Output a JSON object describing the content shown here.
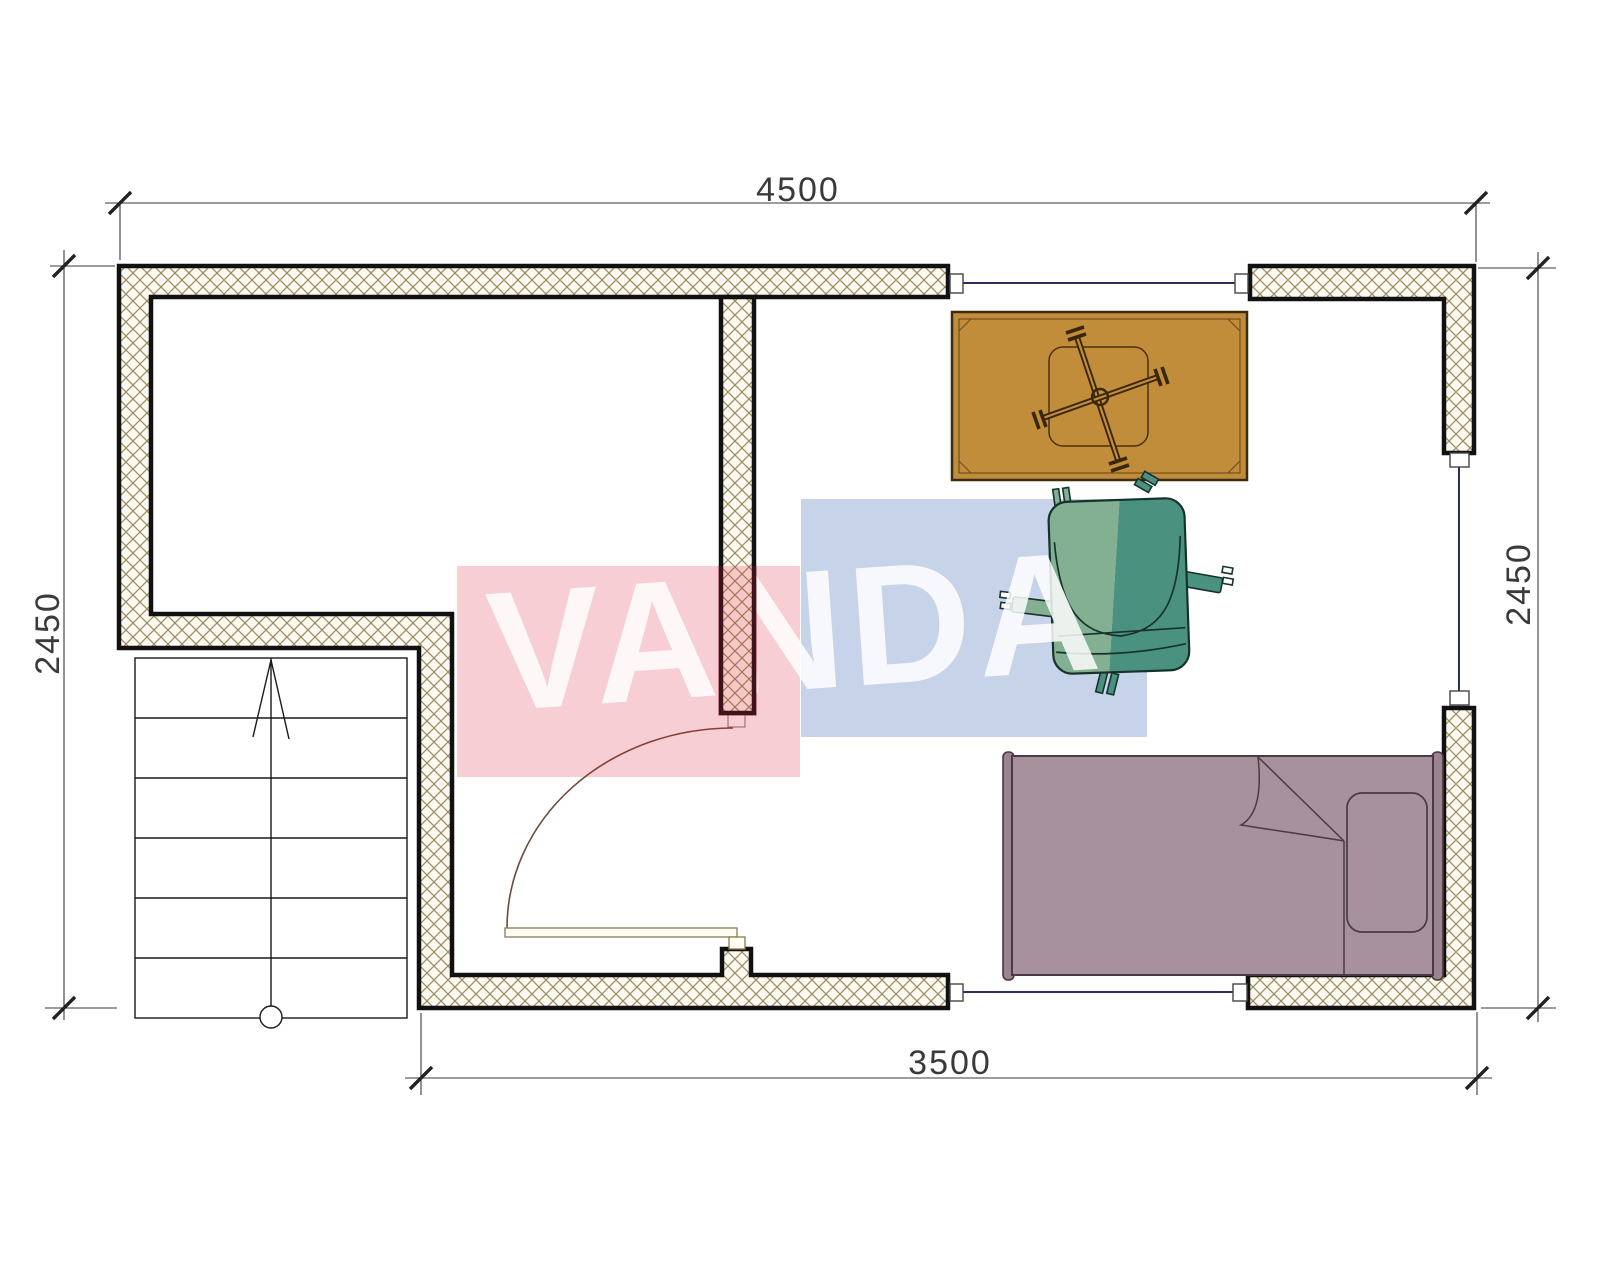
{
  "watermark": {
    "text": "VANDA",
    "text_style": "color: rgba(255,255,255,0.84)",
    "red_overlay": "rgba(220,30,55,0.22)",
    "blue_overlay": "rgba(70,110,180,0.30)"
  },
  "dimensions": {
    "top_label": "4500",
    "left_label": "2450",
    "right_label": "2450",
    "bottom_label": "3500"
  },
  "colors": {
    "wall_outline": "#111111",
    "hatch_line": "#9b8b62",
    "hatch_bg": "#fcf9f0",
    "window_line": "#2e2e5c",
    "marker_stroke": "#444444",
    "door_arc": "#6e4a3c",
    "door_leaf_stroke": "#8a7a4e",
    "door_leaf_fill": "#fffdf4",
    "stair_line": "#1a1a1a",
    "dim_line": "#3a3a3a",
    "dim_tick": "#222222",
    "dim_text": "#3a3a3a",
    "table_fill": "#c28d3a",
    "table_outline": "#3f2c0d",
    "table_inner": "#6b4c1c",
    "table_cross": "#3a2708",
    "chair_light": "#83b092",
    "chair_dark": "#4b9180",
    "chair_outline": "#16332b",
    "bed_fill": "#a6919c",
    "bed_post_fill": "#9a8490",
    "bed_outline": "#4a3a44"
  }
}
